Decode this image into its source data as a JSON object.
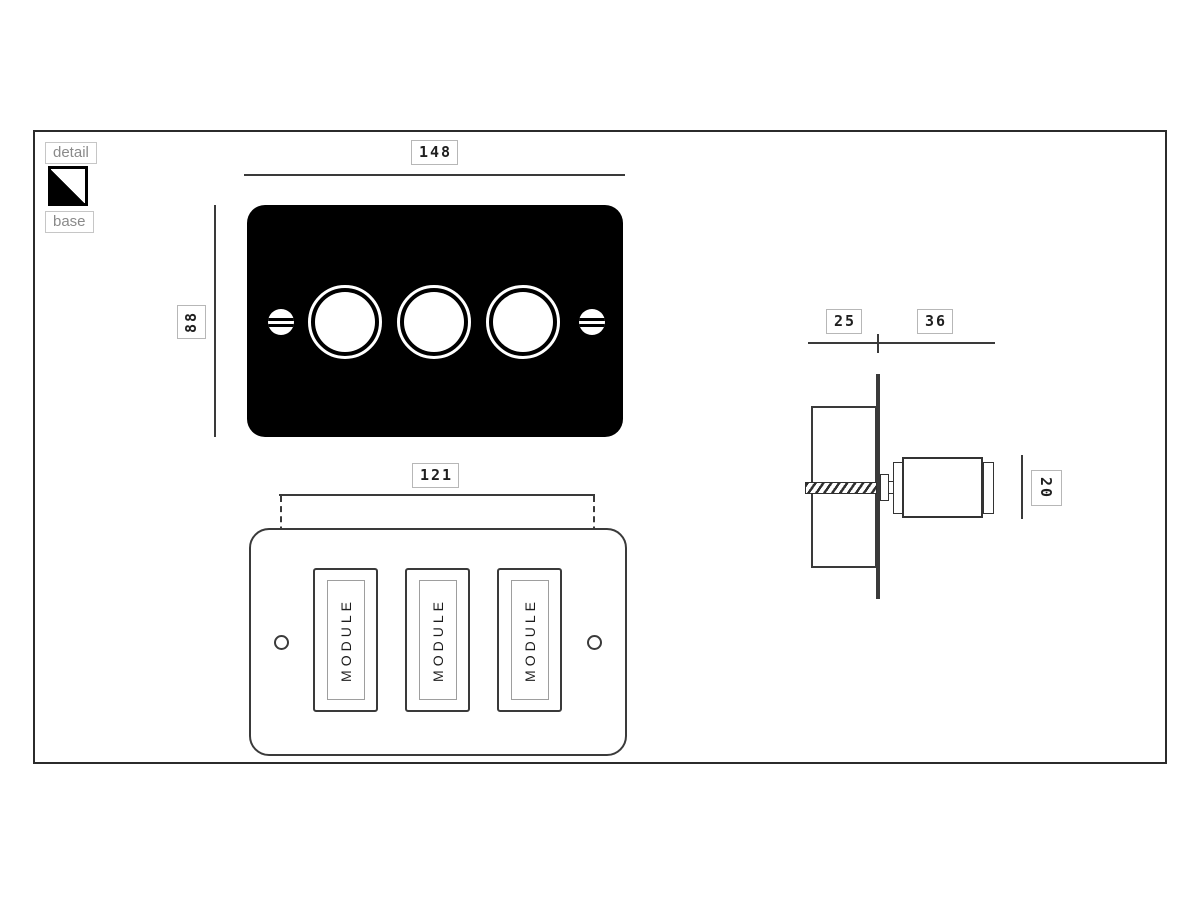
{
  "legend": {
    "detail_label": "detail",
    "base_label": "base",
    "swatch_style": "black-gloss-diagonal"
  },
  "dimensions": {
    "plate_width": "148",
    "plate_height": "88",
    "fixing_centres": "121",
    "depth_behind": "25",
    "projection_front": "36",
    "knob_diameter": "20"
  },
  "base_view": {
    "module_labels": [
      "MODULE",
      "MODULE",
      "MODULE"
    ]
  },
  "icons": {
    "screw_slot": "screw-head",
    "finish_swatch": "finish-swatch"
  },
  "colors": {
    "line": "#3a3a3a",
    "plate_fill": "#000000",
    "label_text": "#1f1f1f",
    "label_border": "#b7b7b7",
    "muted_text": "#8a8a8a"
  }
}
